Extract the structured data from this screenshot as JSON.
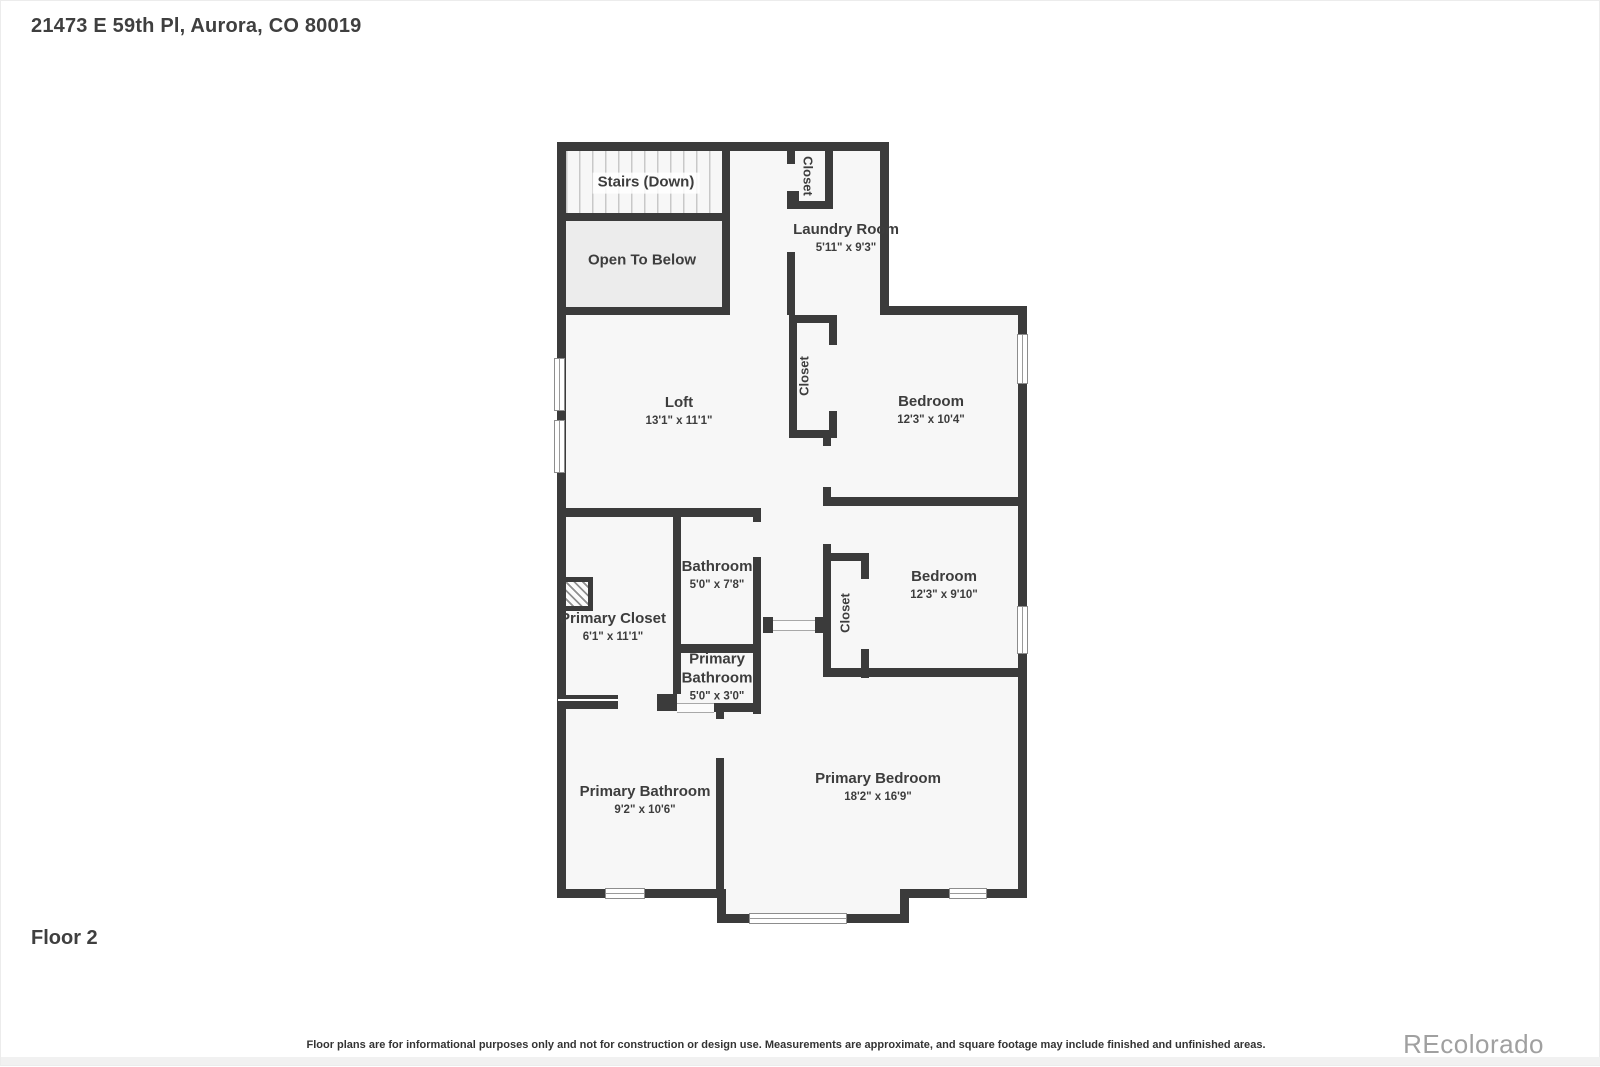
{
  "header": {
    "title": "21473 E 59th Pl, Aurora, CO 80019"
  },
  "footer": {
    "floor_label": "Floor 2",
    "disclaimer": "Floor plans are for informational purposes only and not for construction or design use. Measurements are approximate, and square footage may include finished and unfinished areas.",
    "watermark": "REcolorado"
  },
  "colors": {
    "wall": "#3b3b3b",
    "room_fill": "#f7f7f7",
    "open_to_below_fill": "#ececec",
    "label_text": "#3d3d3d",
    "watermark_text": "#a0a0a0"
  },
  "plan": {
    "rooms": {
      "stairs": {
        "name": "Stairs (Down)",
        "dims": ""
      },
      "open_to_below": {
        "name": "Open To Below",
        "dims": ""
      },
      "laundry": {
        "name": "Laundry Room",
        "dims": "5'11\" x 9'3\""
      },
      "loft": {
        "name": "Loft",
        "dims": "13'1\" x 11'1\""
      },
      "bedroom1": {
        "name": "Bedroom",
        "dims": "12'3\" x 10'4\""
      },
      "bathroom": {
        "name": "Bathroom",
        "dims": "5'0\" x 7'8\""
      },
      "primary_closet": {
        "name": "Primary Closet",
        "dims": "6'1\" x 11'1\""
      },
      "bedroom2": {
        "name": "Bedroom",
        "dims": "12'3\" x 9'10\""
      },
      "primary_bathroom_small": {
        "name": "Primary Bathroom",
        "dims": "5'0\" x 3'0\""
      },
      "primary_bathroom": {
        "name": "Primary Bathroom",
        "dims": "9'2\" x 10'6\""
      },
      "primary_bedroom": {
        "name": "Primary Bedroom",
        "dims": "18'2\" x 16'9\""
      }
    },
    "closets": {
      "stairs_closet": "Closet",
      "bedroom1_closet": "Closet",
      "bedroom2_closet": "Closet"
    }
  }
}
